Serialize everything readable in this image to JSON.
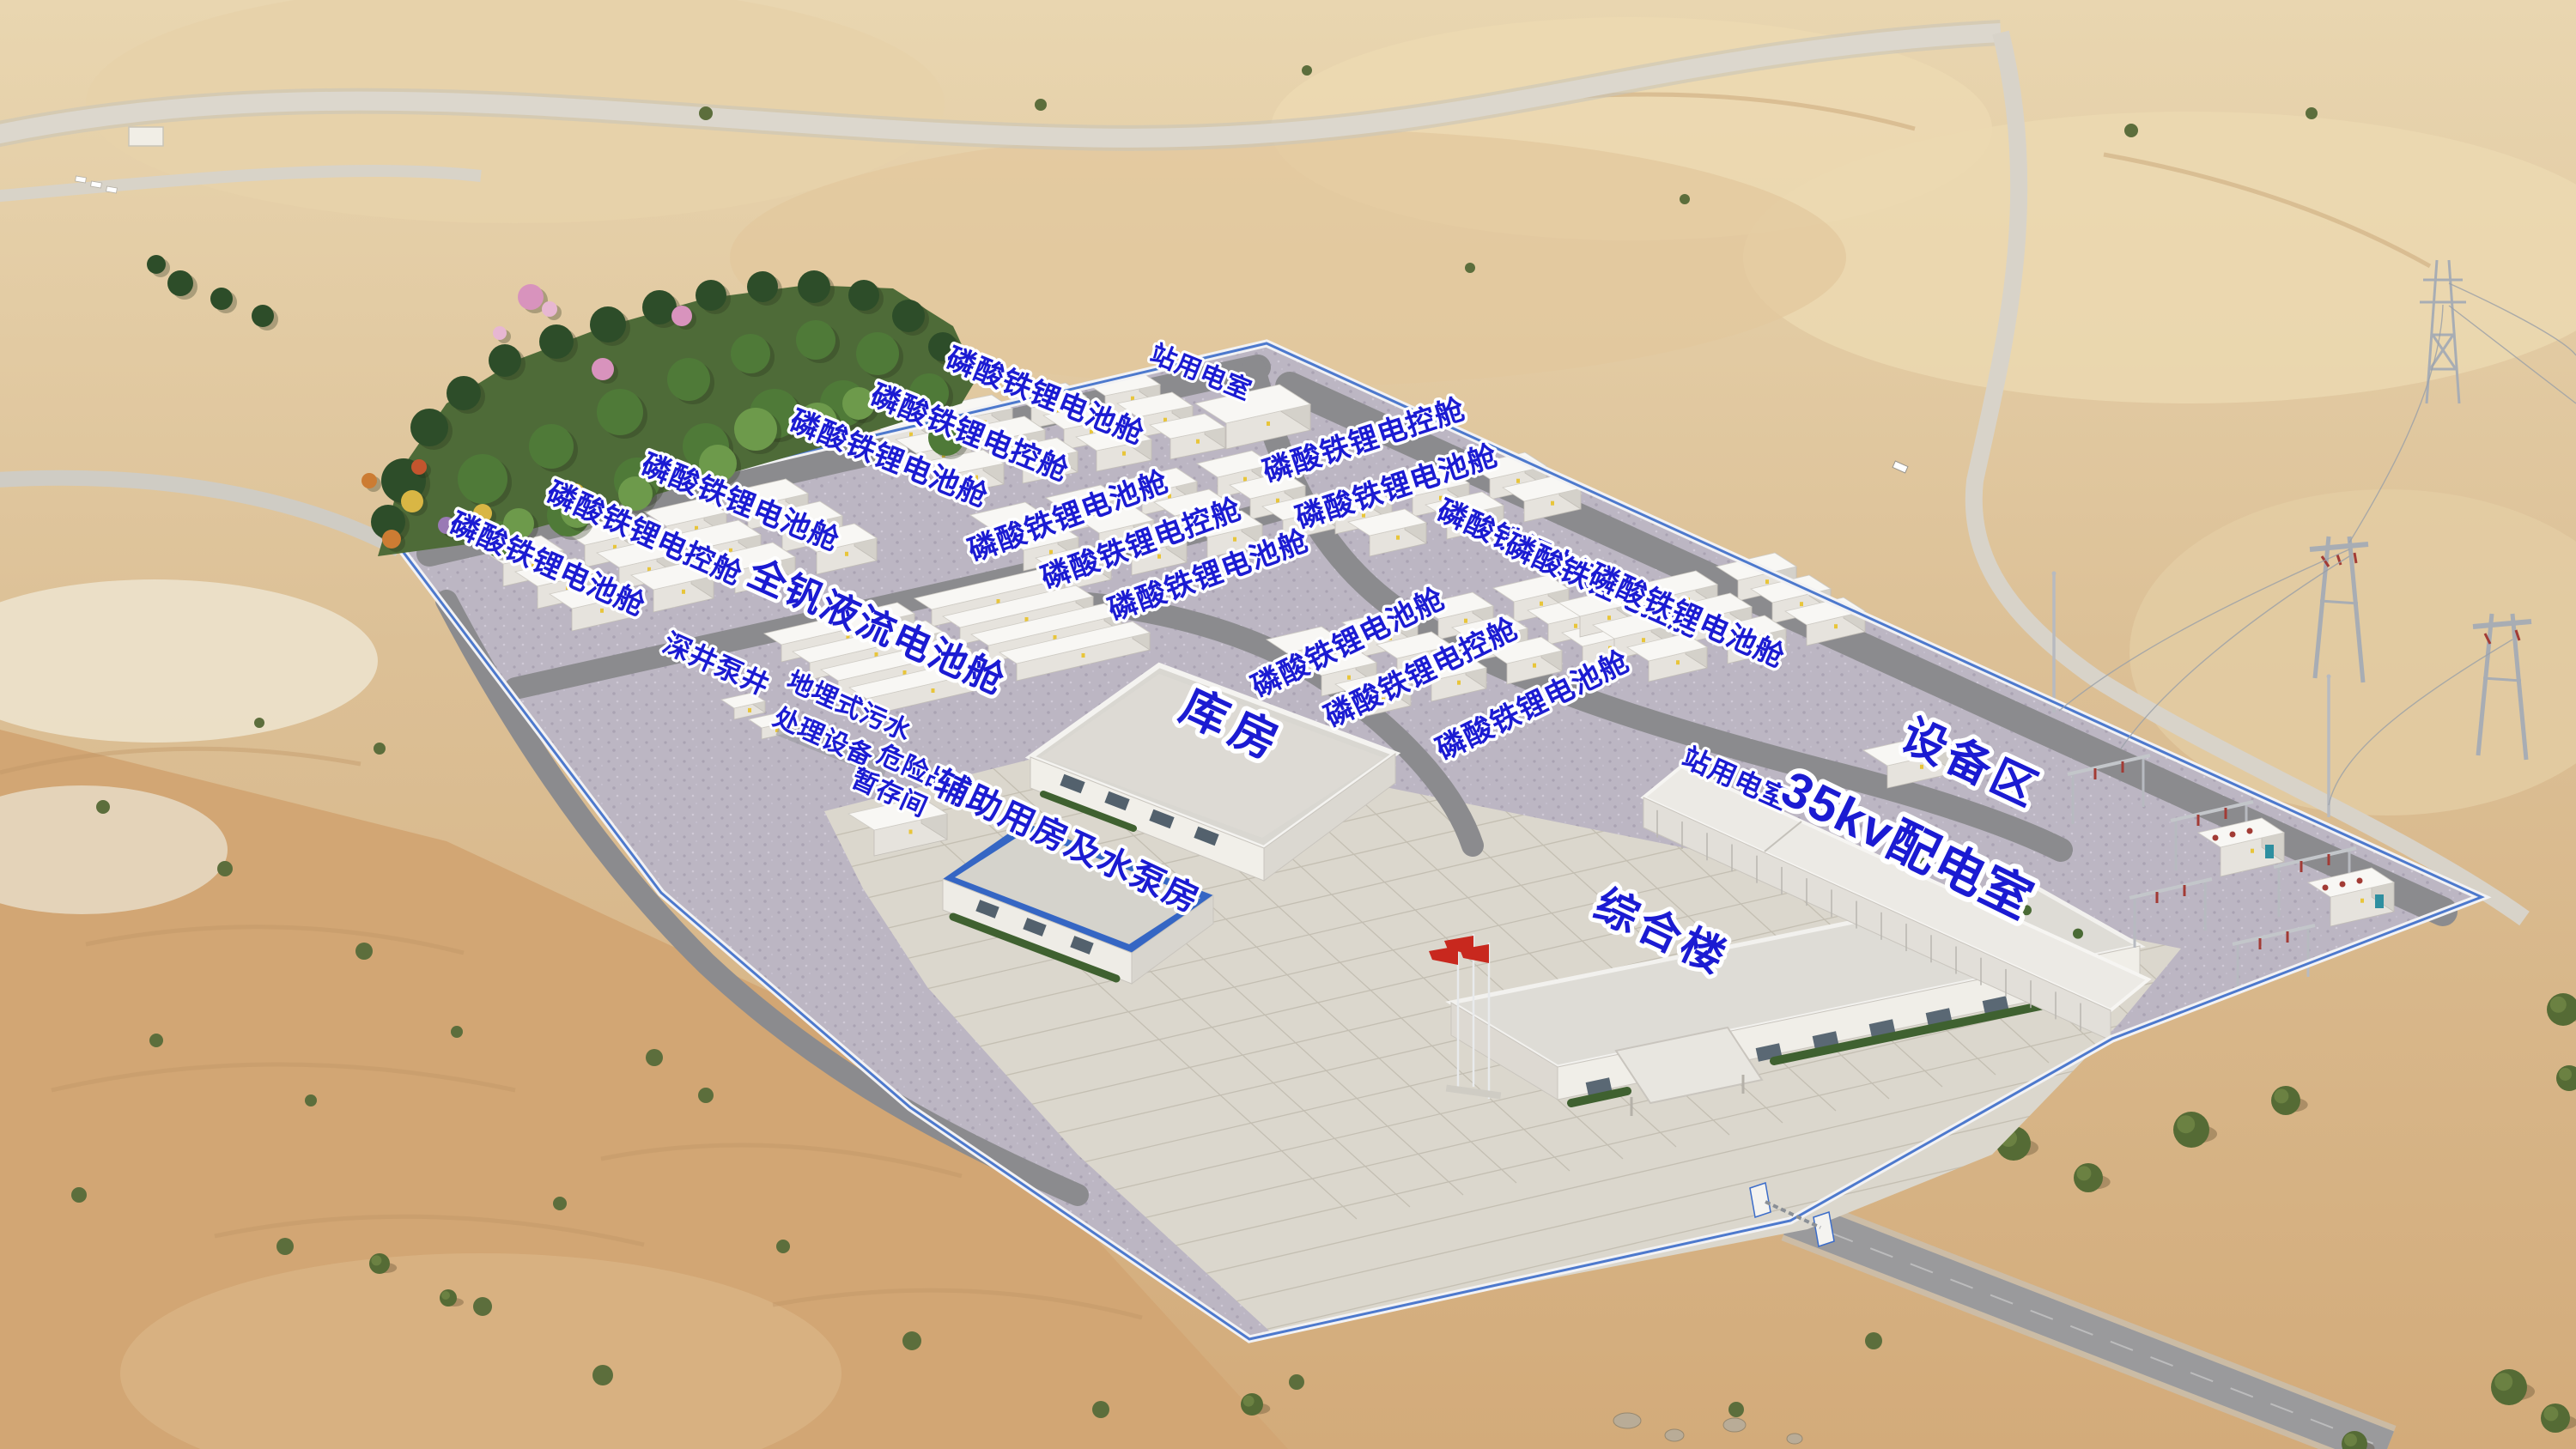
{
  "labels": {
    "battery_cabin": "磷酸铁锂电池舱",
    "battery_control_cabin": "磷酸铁锂电控舱",
    "station_power_room": "站用电室",
    "vanadium_flow_battery_cabin": "全钒液流电池舱",
    "deep_well_pump_well": "深井泵井",
    "buried_sewage_treatment_line1": "地埋式污水",
    "buried_sewage_treatment_line2": "处理设备",
    "hazardous_storage_line1": "危险品",
    "hazardous_storage_line2": "暂存间",
    "auxiliary_and_pump_house": "辅助用房及水泵房",
    "warehouse": "库房",
    "comprehensive_building": "综合楼",
    "distribution_room_35kv": "35kv配电室",
    "equipment_area": "设备区"
  },
  "colors": {
    "label_blue": "#1b1bd2",
    "label_outline": "#ffffff",
    "wall_trim_blue": "#3b6cc9",
    "flag_red": "#c8281e",
    "container_white": "#f8f7f4",
    "concrete_pad": "#bcb6c3",
    "plaza": "#dbd7cd",
    "road_gray": "#8d8d90",
    "desert_sand": "#dbbd92",
    "park_green": "#4e6b38"
  }
}
